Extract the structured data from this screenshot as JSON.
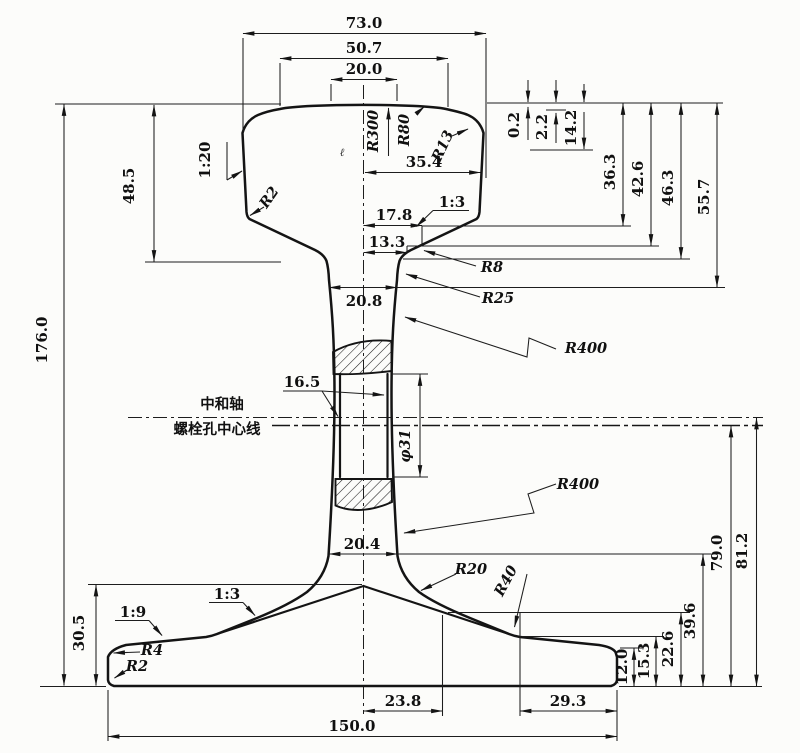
{
  "figure": {
    "kind": "rail cross-section engineering drawing",
    "axis_labels": {
      "neutral_axis": "中和轴",
      "bolt_hole_centerline": "螺栓孔中心线"
    },
    "dimensions": {
      "head_width": "73.0",
      "crown_width_outer": "50.7",
      "crown_width_inner": "20.0",
      "head_half_width": "35.4",
      "crown_drop_1": "0.2",
      "crown_drop_2": "2.2",
      "crown_drop_3": "14.2",
      "head_depth_1": "36.3",
      "head_depth_2": "42.6",
      "head_depth_3": "46.3",
      "head_depth_4": "55.7",
      "head_height": "48.5",
      "total_height": "176.0",
      "web_width_upper": "20.8",
      "web_width_lower": "20.4",
      "head_offset_1": "17.8",
      "head_offset_2": "13.3",
      "web_thickness": "16.5",
      "bolt_hole_dia": "φ31",
      "foot_height": "30.5",
      "foot_offset_center": "23.8",
      "foot_offset_edge": "29.3",
      "foot_width": "150.0",
      "edge_height_1": "12.0",
      "edge_height_2": "15.3",
      "edge_height_3": "22.6",
      "edge_height_4": "39.6",
      "below_axis_1": "79.0",
      "below_axis_2": "81.2"
    },
    "radii": {
      "crown": "R300",
      "shoulder": "R80",
      "head_corner": "R13",
      "head_side": "R2",
      "head_fillet": "R8",
      "web_upper_fillet": "R25",
      "web_curve_upper": "R400",
      "web_curve_lower": "R400",
      "foot_fillet": "R20",
      "foot_slope": "R40",
      "foot_edge_top": "R4",
      "foot_edge_bottom": "R2"
    },
    "slopes": {
      "head_side": "1:20",
      "head_bottom": "1:3",
      "foot_inner": "1:3",
      "foot_outer": "1:9"
    },
    "stray_mark": "ℓ"
  }
}
